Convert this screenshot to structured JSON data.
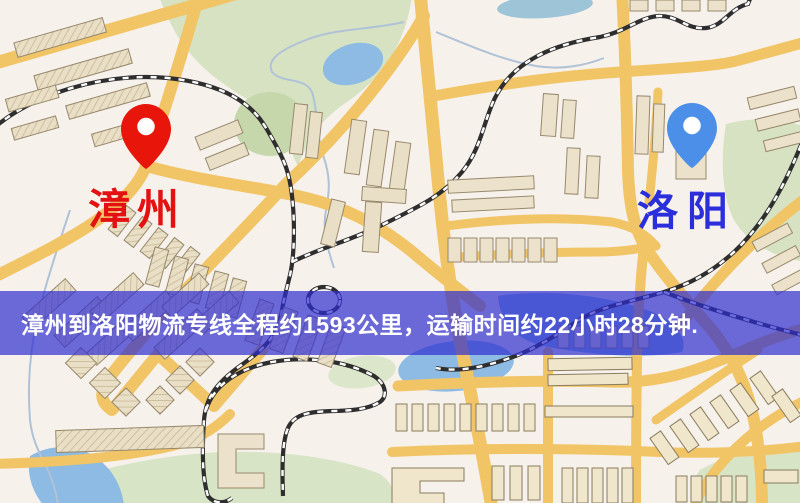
{
  "map": {
    "origin": {
      "label": "漳州",
      "pin_color": "#e8150b",
      "label_color": "#e31112"
    },
    "destination": {
      "label": "洛阳",
      "pin_color": "#4b8fe8",
      "label_color": "#2a2edb"
    },
    "banner": {
      "text": "漳州到洛阳物流专线全程约1593公里，运输时间约22小时28分钟.",
      "background": "rgba(47,46,208,0.70)",
      "text_color": "#ffffff"
    },
    "theme": {
      "land": "#f7f1ec",
      "park": "#d6e2c2",
      "water": "#8dbbe3",
      "road": "#f1c566",
      "railway": "#2e2e2e",
      "building": "#e9dec6"
    }
  }
}
